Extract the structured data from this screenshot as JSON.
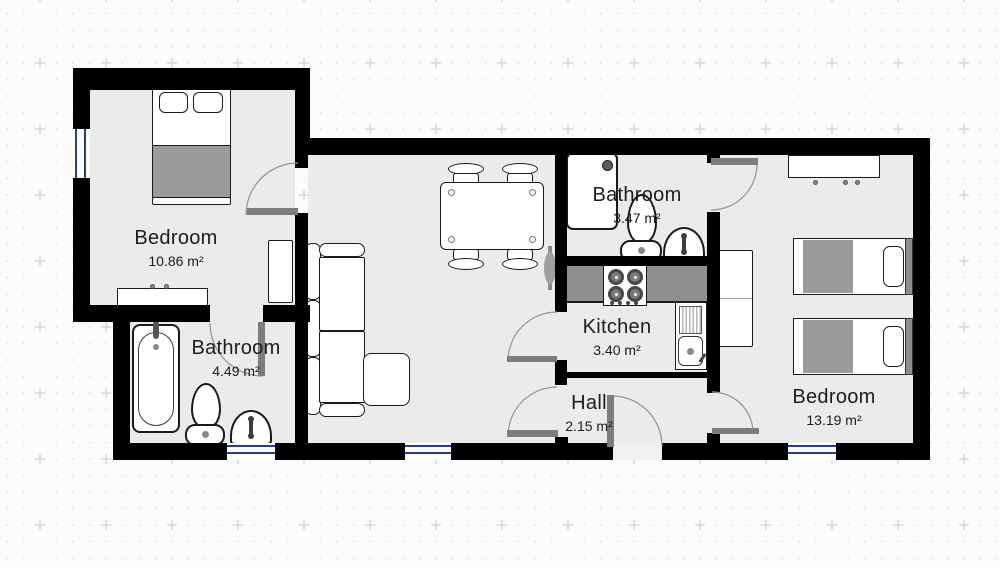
{
  "plan": {
    "type": "floor-plan",
    "rooms": [
      {
        "id": "bedroom-left",
        "name": "Bedroom",
        "area": "10.86 m²"
      },
      {
        "id": "bathroom-left",
        "name": "Bathroom",
        "area": "4.49 m²"
      },
      {
        "id": "bathroom-top",
        "name": "Bathroom",
        "area": "3.47 m²"
      },
      {
        "id": "kitchen",
        "name": "Kitchen",
        "area": "3.40 m²"
      },
      {
        "id": "hall",
        "name": "Hall",
        "area": "2.15 m²"
      },
      {
        "id": "bedroom-right",
        "name": "Bedroom",
        "area": "13.19 m²"
      }
    ],
    "furniture": [
      "double-bed",
      "dresser",
      "wardrobe",
      "bathtub",
      "toilet",
      "wash-basin",
      "corner-sofa",
      "dining-table",
      "chair",
      "radiator",
      "shower",
      "stove",
      "kitchen-sink",
      "single-bed"
    ],
    "colors": {
      "wall": "#000000",
      "floor": "#ebebeb",
      "door_leaf": "#7d7d7d",
      "door_arc": "#999999",
      "window_frame": "#2b3990",
      "furniture_gray": "#9b9b9b",
      "counter_gray": "#8f8f8f",
      "label_text": "#1c1c1c",
      "grid_dot": "#dadfe4",
      "grid_cross": "#c6d2db",
      "canvas": "#fbfbfb"
    }
  }
}
